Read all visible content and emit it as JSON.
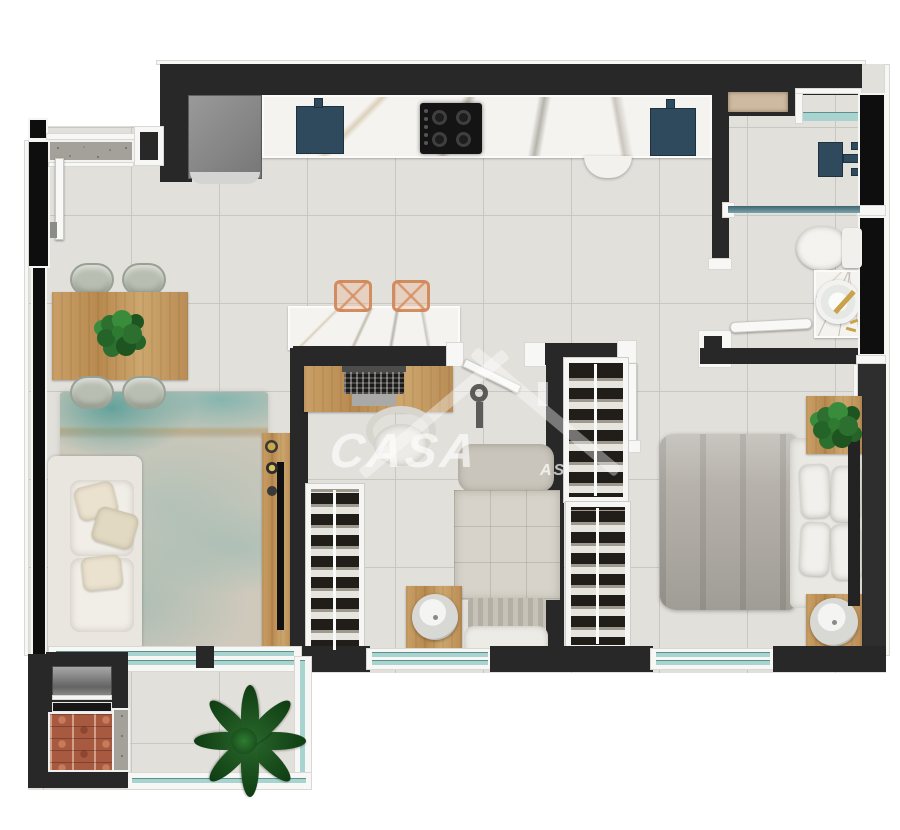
{
  "watermark": {
    "brand": "CASA",
    "fragment": "AS",
    "logo": "house-roof-with-key-icon"
  },
  "palette": {
    "wall": "#282828",
    "floor": "#e2e0db",
    "grout": "#c9c7c2",
    "marble": "#f5f3f0",
    "wood": "#c49a60",
    "glass": "#a9d3cf",
    "fixture": "#2e4a5c",
    "rugbase": "#cfc9bc",
    "rugteal": "#7fb2ac",
    "duvet": "#b6b2ab",
    "sofa": "#efece6",
    "brick": "#a85a40",
    "stoolacrylic": "#d1885a",
    "plantgreen": "#2c6f2e",
    "gold": "#c9a24b",
    "granite": "#a3a199",
    "wmcolor": "rgba(255,255,255,0.55)"
  },
  "scene": {
    "type": "apartment-floor-plan-top-view",
    "rooms": [
      {
        "name": "kitchen",
        "items": [
          "refrigerator",
          "counter-sink",
          "cooktop",
          "second-sink",
          "island-counter",
          "two-bar-stools"
        ]
      },
      {
        "name": "dining-area",
        "items": [
          "wood-table",
          "four-chairs",
          "centerpiece-plant"
        ]
      },
      {
        "name": "living-room",
        "items": [
          "white-sofa",
          "abstract-rug",
          "tv-console"
        ]
      },
      {
        "name": "balcony",
        "items": [
          "barbecue-grill",
          "large-plant",
          "glass-railing",
          "sliding-glass-door"
        ]
      },
      {
        "name": "bedroom-1",
        "items": [
          "desk-with-laptop",
          "chair",
          "open-wardrobe",
          "single-bed",
          "nightstand-with-lamp"
        ]
      },
      {
        "name": "bedroom-2",
        "items": [
          "double-bed",
          "two-open-wardrobes",
          "two-nightstands",
          "plant"
        ]
      },
      {
        "name": "bathroom",
        "items": [
          "shower-head",
          "glass-partition",
          "toilet",
          "round-basin-vanity",
          "wall-niche"
        ]
      },
      {
        "name": "entry",
        "items": [
          "entry-door",
          "granite-threshold"
        ]
      }
    ]
  }
}
